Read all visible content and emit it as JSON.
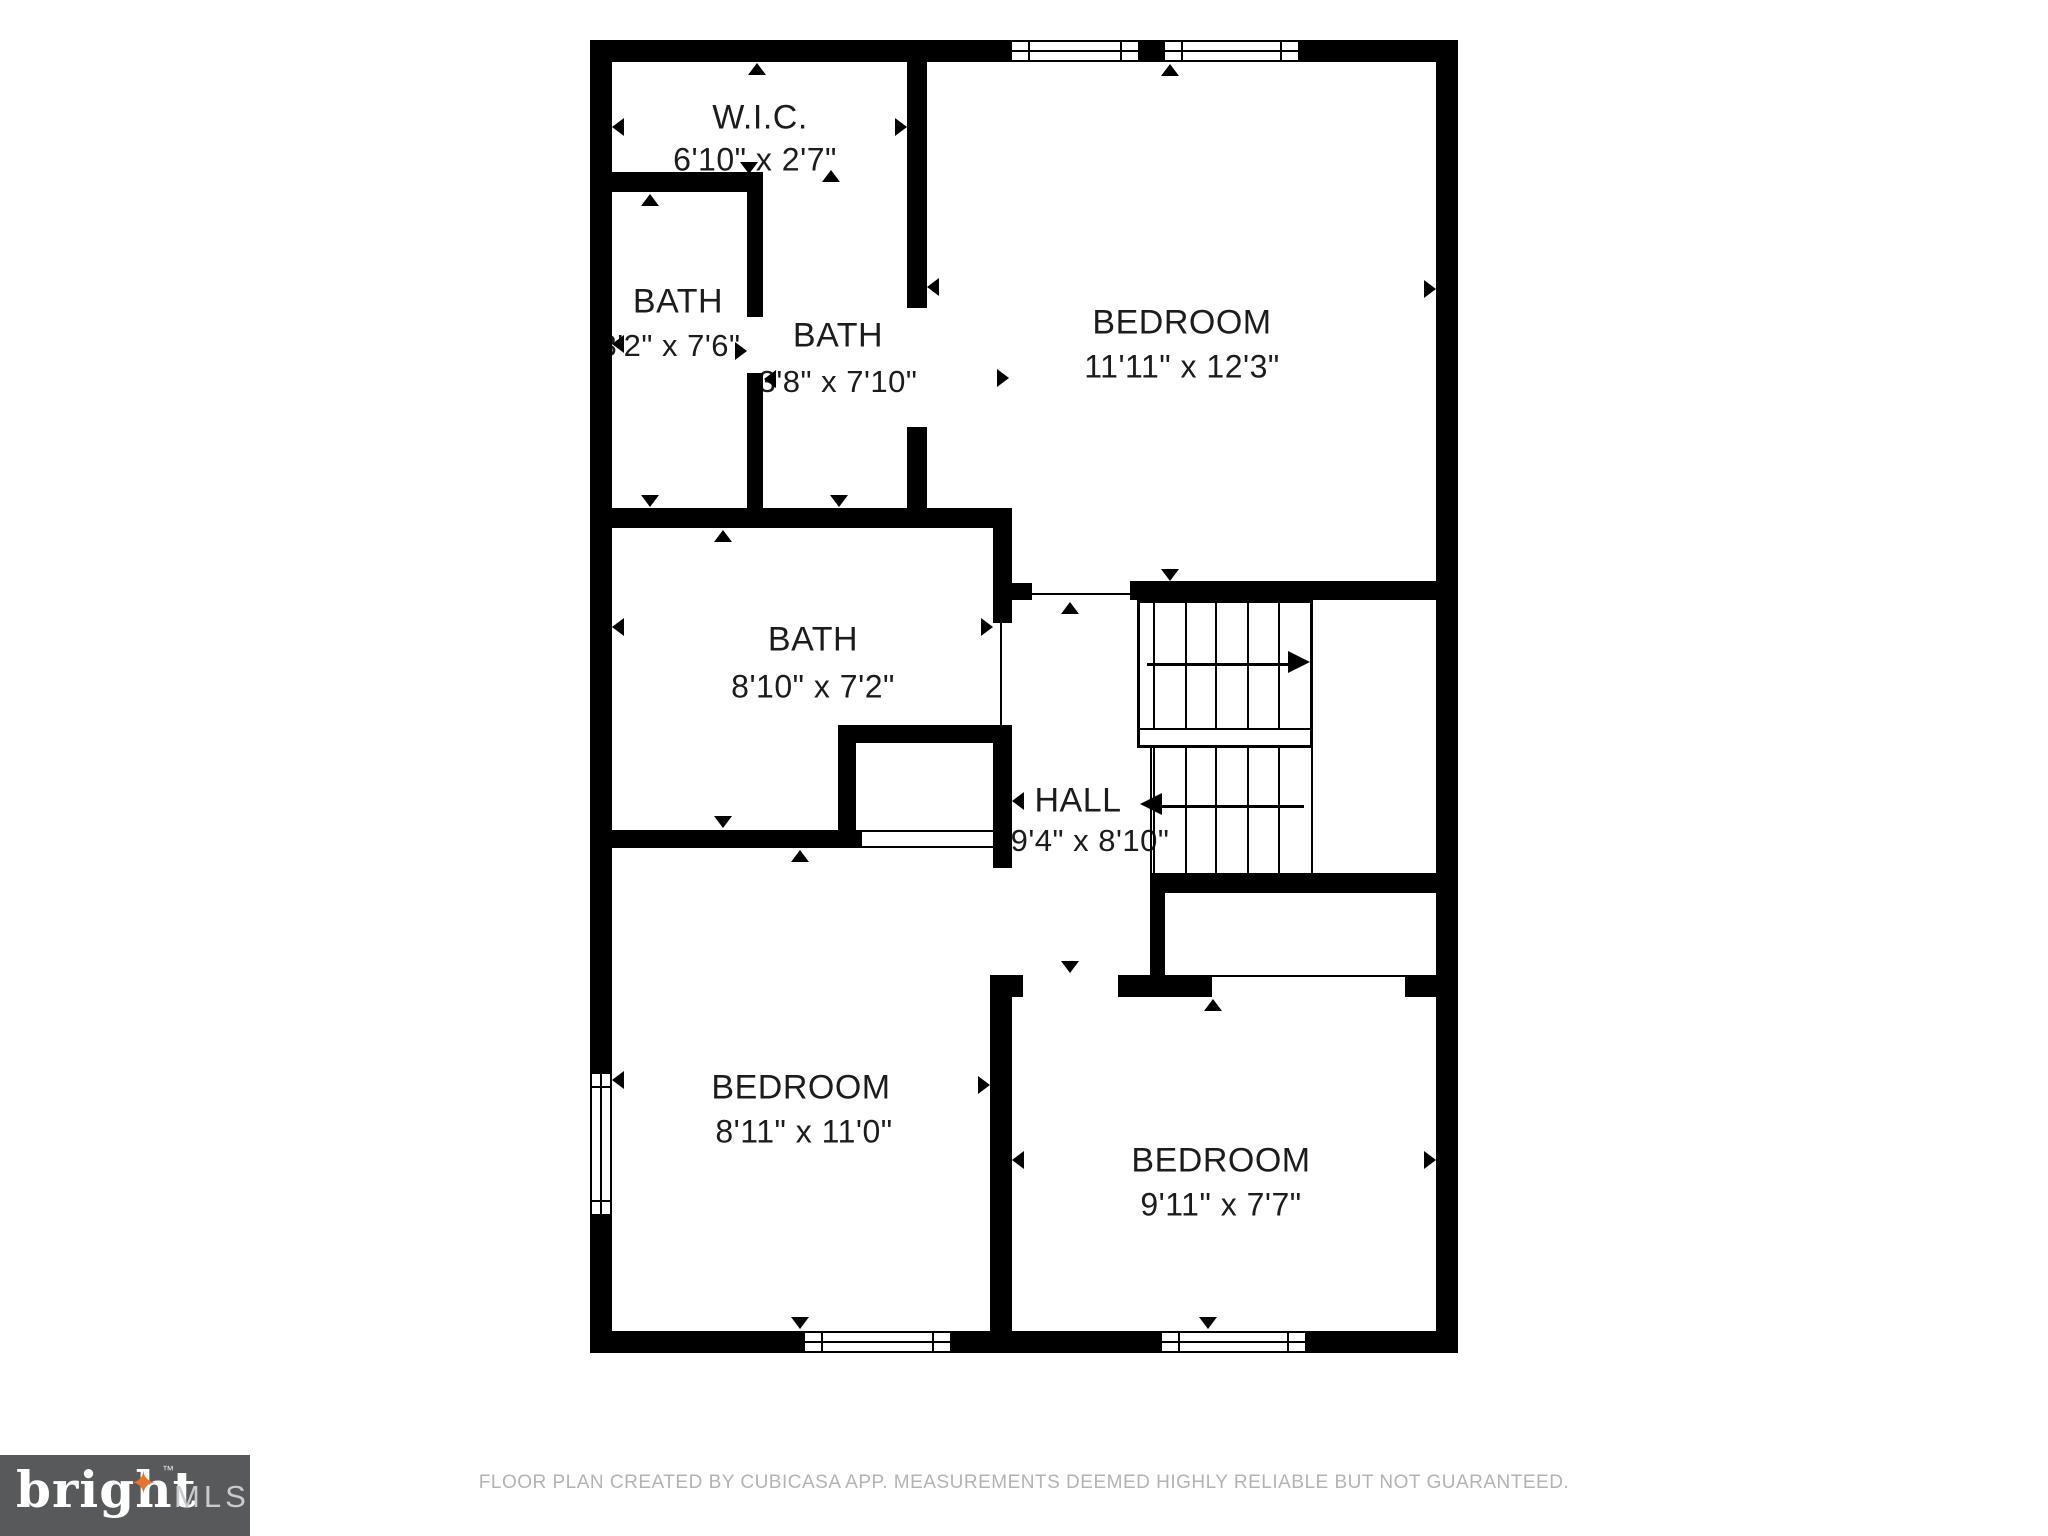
{
  "rooms": {
    "wic": {
      "name": "W.I.C.",
      "dims": "6'10\" x 2'7\""
    },
    "bath_left": {
      "name": "BATH",
      "dims": "3'2\" x 7'6\""
    },
    "bath_middle": {
      "name": "BATH",
      "dims": "3'8\" x 7'10\""
    },
    "bath_main": {
      "name": "BATH",
      "dims": "8'10\" x 7'2\""
    },
    "hall": {
      "name": "HALL",
      "dims": "9'4\" x 8'10\""
    },
    "bedroom_top": {
      "name": "BEDROOM",
      "dims": "11'11\" x 12'3\""
    },
    "bedroom_left": {
      "name": "BEDROOM",
      "dims": "8'11\" x 11'0\""
    },
    "bedroom_right": {
      "name": "BEDROOM",
      "dims": "9'11\" x 7'7\""
    }
  },
  "footer": {
    "disclaimer": "FLOOR PLAN CREATED BY CUBICASA APP. MEASUREMENTS DEEMED HIGHLY RELIABLE BUT NOT GUARANTEED."
  },
  "logo": {
    "brand": "bright",
    "tm": "™",
    "suffix": "MLS"
  },
  "colors": {
    "wall": "#000000",
    "logo_bg": "#58595B",
    "logo_star": "#E8742C",
    "footer_text": "#b3b3b3"
  }
}
